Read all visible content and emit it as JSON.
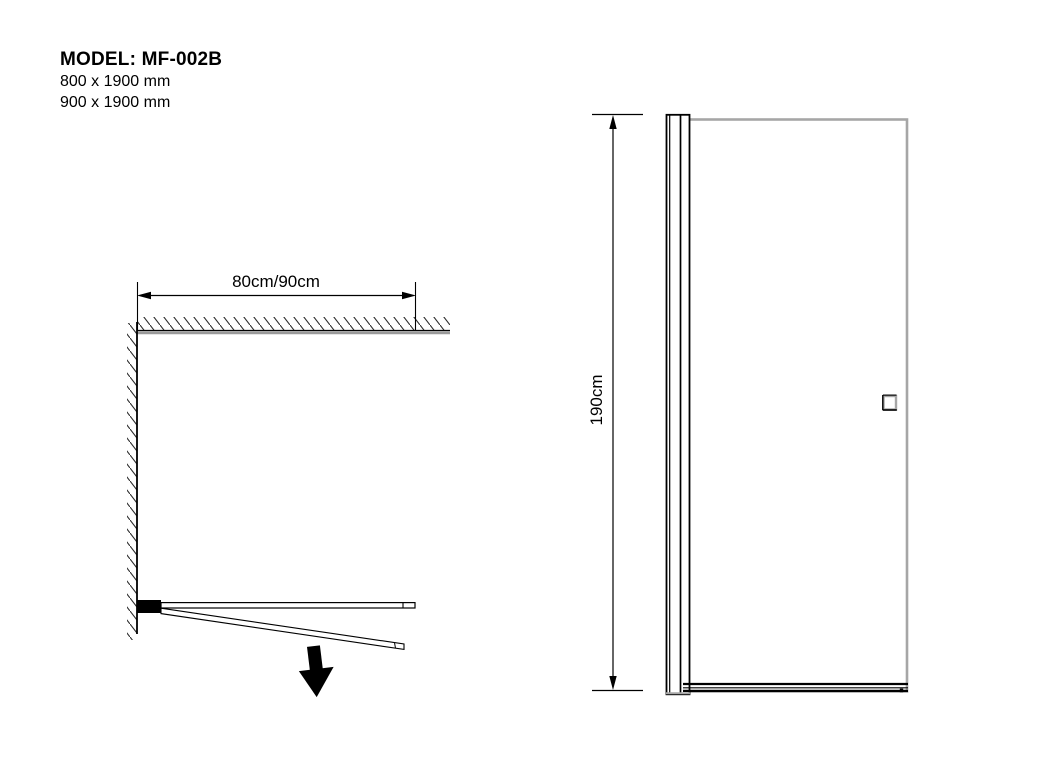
{
  "title": {
    "model": "MODEL: MF-002B",
    "sizes": [
      "800 x 1900 mm",
      "900 x 1900 mm"
    ]
  },
  "plan_view": {
    "width_label": "80cm/90cm"
  },
  "elevation_view": {
    "height_label": "190cm"
  },
  "colors": {
    "line_black": "#000000",
    "glass_gray": "#a6a6a6",
    "wall_gray": "#9a9a9a",
    "clamp_gray": "#5a5a5a",
    "handle_gray": "#4a4a4a"
  }
}
